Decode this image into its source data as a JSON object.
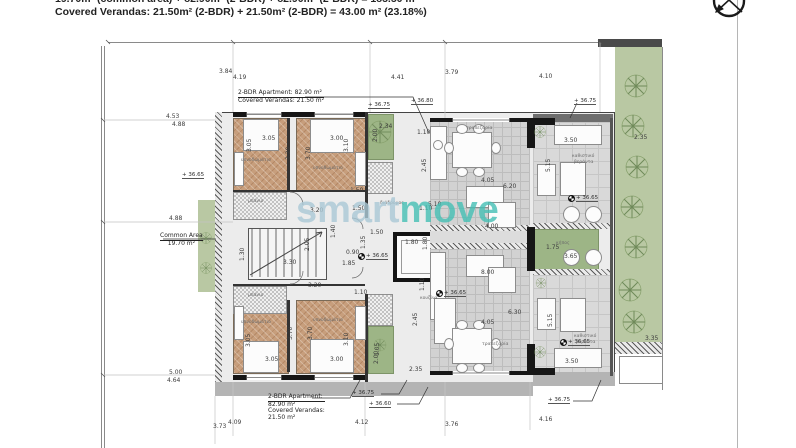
{
  "header": {
    "line1": "19.70m² (common area) + 82.90m² (2-BDR) + 82.90m² (2-BDR) = 185.50 m²",
    "line2": "Covered Verandas: 21.50m² (2-BDR) + 21.50m² (2-BDR) = 43.00 m² (23.18%)"
  },
  "watermark": {
    "part1": "smart",
    "part2": "move",
    "color1": "#abc9d6",
    "color2": "#45c0b5"
  },
  "callouts": {
    "top_apartment": {
      "line1": "2-BDR Apartment: 82.90 m²",
      "line2": "Covered Verandas: 21.50 m²"
    },
    "bottom_apartment": {
      "line1": "2-BDR Apartment:",
      "line2": "82.90 m²",
      "line3": "Covered Verandas:",
      "line4": "21.50 m²"
    },
    "common_area": {
      "line1": "Common Area",
      "line2": "19.70 m²"
    }
  },
  "dimensions": [
    {
      "t": "3.84",
      "x": 219,
      "y": 69
    },
    {
      "t": "4.19",
      "x": 233,
      "y": 75
    },
    {
      "t": "4.41",
      "x": 391,
      "y": 75
    },
    {
      "t": "3.79",
      "x": 445,
      "y": 70
    },
    {
      "t": "4.10",
      "x": 539,
      "y": 74
    },
    {
      "t": "4.53",
      "x": 166,
      "y": 114
    },
    {
      "t": "4.88",
      "x": 172,
      "y": 122
    },
    {
      "t": "4.88",
      "x": 169,
      "y": 216
    },
    {
      "t": "5.00",
      "x": 169,
      "y": 370
    },
    {
      "t": "4.64",
      "x": 167,
      "y": 378
    },
    {
      "t": "3.73",
      "x": 213,
      "y": 424
    },
    {
      "t": "4.09",
      "x": 228,
      "y": 420
    },
    {
      "t": "4.12",
      "x": 355,
      "y": 420
    },
    {
      "t": "3.76",
      "x": 445,
      "y": 422
    },
    {
      "t": "4.16",
      "x": 539,
      "y": 417
    },
    {
      "t": "3.05",
      "x": 262,
      "y": 136
    },
    {
      "t": "3.05",
      "x": 247,
      "y": 152,
      "r": 90
    },
    {
      "t": "3.00",
      "x": 330,
      "y": 136
    },
    {
      "t": "3.10",
      "x": 344,
      "y": 152,
      "r": 90
    },
    {
      "t": "3.20",
      "x": 286,
      "y": 160,
      "r": 90
    },
    {
      "t": "3.70",
      "x": 306,
      "y": 160,
      "r": 90
    },
    {
      "t": "2.34",
      "x": 379,
      "y": 124
    },
    {
      "t": "1.10",
      "x": 417,
      "y": 130
    },
    {
      "t": "2.45",
      "x": 422,
      "y": 172,
      "r": 90
    },
    {
      "t": "1.50",
      "x": 350,
      "y": 188
    },
    {
      "t": "3.20",
      "x": 310,
      "y": 208
    },
    {
      "t": "1.50",
      "x": 352,
      "y": 206
    },
    {
      "t": "1.10",
      "x": 419,
      "y": 206
    },
    {
      "t": "4.05",
      "x": 481,
      "y": 178
    },
    {
      "t": "6.20",
      "x": 503,
      "y": 184
    },
    {
      "t": "3.50",
      "x": 564,
      "y": 138
    },
    {
      "t": "5.15",
      "x": 546,
      "y": 172,
      "r": 90
    },
    {
      "t": "5.10",
      "x": 428,
      "y": 202
    },
    {
      "t": "2.00",
      "x": 373,
      "y": 142,
      "r": 90
    },
    {
      "t": "1.30",
      "x": 240,
      "y": 261,
      "r": 90
    },
    {
      "t": "3.30",
      "x": 283,
      "y": 260
    },
    {
      "t": "1.40",
      "x": 331,
      "y": 238,
      "r": 90
    },
    {
      "t": "0.90",
      "x": 346,
      "y": 250
    },
    {
      "t": "1.85",
      "x": 342,
      "y": 261
    },
    {
      "t": "1.35",
      "x": 361,
      "y": 249,
      "r": 90
    },
    {
      "t": "1.50",
      "x": 370,
      "y": 230
    },
    {
      "t": "1.80",
      "x": 405,
      "y": 240
    },
    {
      "t": "1.80",
      "x": 423,
      "y": 250,
      "r": 90
    },
    {
      "t": "2.05",
      "x": 305,
      "y": 251,
      "r": 90
    },
    {
      "t": "4.00",
      "x": 485,
      "y": 224
    },
    {
      "t": "1.75",
      "x": 546,
      "y": 245
    },
    {
      "t": "3.65",
      "x": 564,
      "y": 254
    },
    {
      "t": "8.00",
      "x": 481,
      "y": 270
    },
    {
      "t": "3.20",
      "x": 308,
      "y": 283
    },
    {
      "t": "1.10",
      "x": 354,
      "y": 290
    },
    {
      "t": "3.70",
      "x": 288,
      "y": 340,
      "r": 90
    },
    {
      "t": "3.70",
      "x": 308,
      "y": 340,
      "r": 90
    },
    {
      "t": "3.05",
      "x": 246,
      "y": 347,
      "r": 90
    },
    {
      "t": "3.05",
      "x": 265,
      "y": 357
    },
    {
      "t": "3.00",
      "x": 330,
      "y": 357
    },
    {
      "t": "3.10",
      "x": 344,
      "y": 346,
      "r": 90
    },
    {
      "t": "1.05",
      "x": 375,
      "y": 356,
      "r": 90
    },
    {
      "t": "2.00",
      "x": 374,
      "y": 364,
      "r": 90
    },
    {
      "t": "2.35",
      "x": 409,
      "y": 367
    },
    {
      "t": "1.10",
      "x": 420,
      "y": 291,
      "r": 90
    },
    {
      "t": "2.45",
      "x": 413,
      "y": 326,
      "r": 90
    },
    {
      "t": "4.05",
      "x": 481,
      "y": 320
    },
    {
      "t": "6.30",
      "x": 508,
      "y": 310
    },
    {
      "t": "3.50",
      "x": 565,
      "y": 359
    },
    {
      "t": "5.15",
      "x": 548,
      "y": 327,
      "r": 90
    },
    {
      "t": "2.35",
      "x": 634,
      "y": 135
    },
    {
      "t": "3.35",
      "x": 645,
      "y": 336
    }
  ],
  "elevations": [
    {
      "t": "+ 36.75",
      "x": 368,
      "y": 102
    },
    {
      "t": "+ 36.80",
      "x": 411,
      "y": 98
    },
    {
      "t": "+ 36.75",
      "x": 574,
      "y": 98
    },
    {
      "t": "+ 36.65",
      "x": 182,
      "y": 172
    },
    {
      "t": "+ 36.65",
      "x": 568,
      "y": 195,
      "s": 1
    },
    {
      "t": "+ 36.65",
      "x": 436,
      "y": 290,
      "s": 1
    },
    {
      "t": "+ 36.65",
      "x": 560,
      "y": 339,
      "s": 1
    },
    {
      "t": "+ 36.65",
      "x": 358,
      "y": 253,
      "s": 1
    },
    {
      "t": "+ 36.75",
      "x": 352,
      "y": 390
    },
    {
      "t": "+ 36.60",
      "x": 369,
      "y": 401
    },
    {
      "t": "+ 36.75",
      "x": 548,
      "y": 397
    }
  ],
  "room_labels": [
    {
      "t": "υπνοδωμάτιο",
      "x": 241,
      "y": 158
    },
    {
      "t": "υπνοδωμάτιο",
      "x": 313,
      "y": 166
    },
    {
      "t": "υπνοδωμάτιο",
      "x": 241,
      "y": 320
    },
    {
      "t": "υπνοδωμάτιο",
      "x": 313,
      "y": 318
    },
    {
      "t": "τραπεζαρία",
      "x": 466,
      "y": 126
    },
    {
      "t": "τραπεζαρία",
      "x": 482,
      "y": 342
    },
    {
      "t": "καθιστικό",
      "x": 572,
      "y": 154
    },
    {
      "t": "βεράντα",
      "x": 574,
      "y": 160
    },
    {
      "t": "καθιστικό",
      "x": 574,
      "y": 334
    },
    {
      "t": "βεράντα",
      "x": 576,
      "y": 340
    },
    {
      "t": "κουζίνα",
      "x": 420,
      "y": 296
    },
    {
      "t": "μπάνιο",
      "x": 248,
      "y": 199
    },
    {
      "t": "μπάνιο",
      "x": 248,
      "y": 293
    },
    {
      "t": "διάδρομος",
      "x": 380,
      "y": 201
    },
    {
      "t": "κήπος",
      "x": 556,
      "y": 241
    }
  ]
}
